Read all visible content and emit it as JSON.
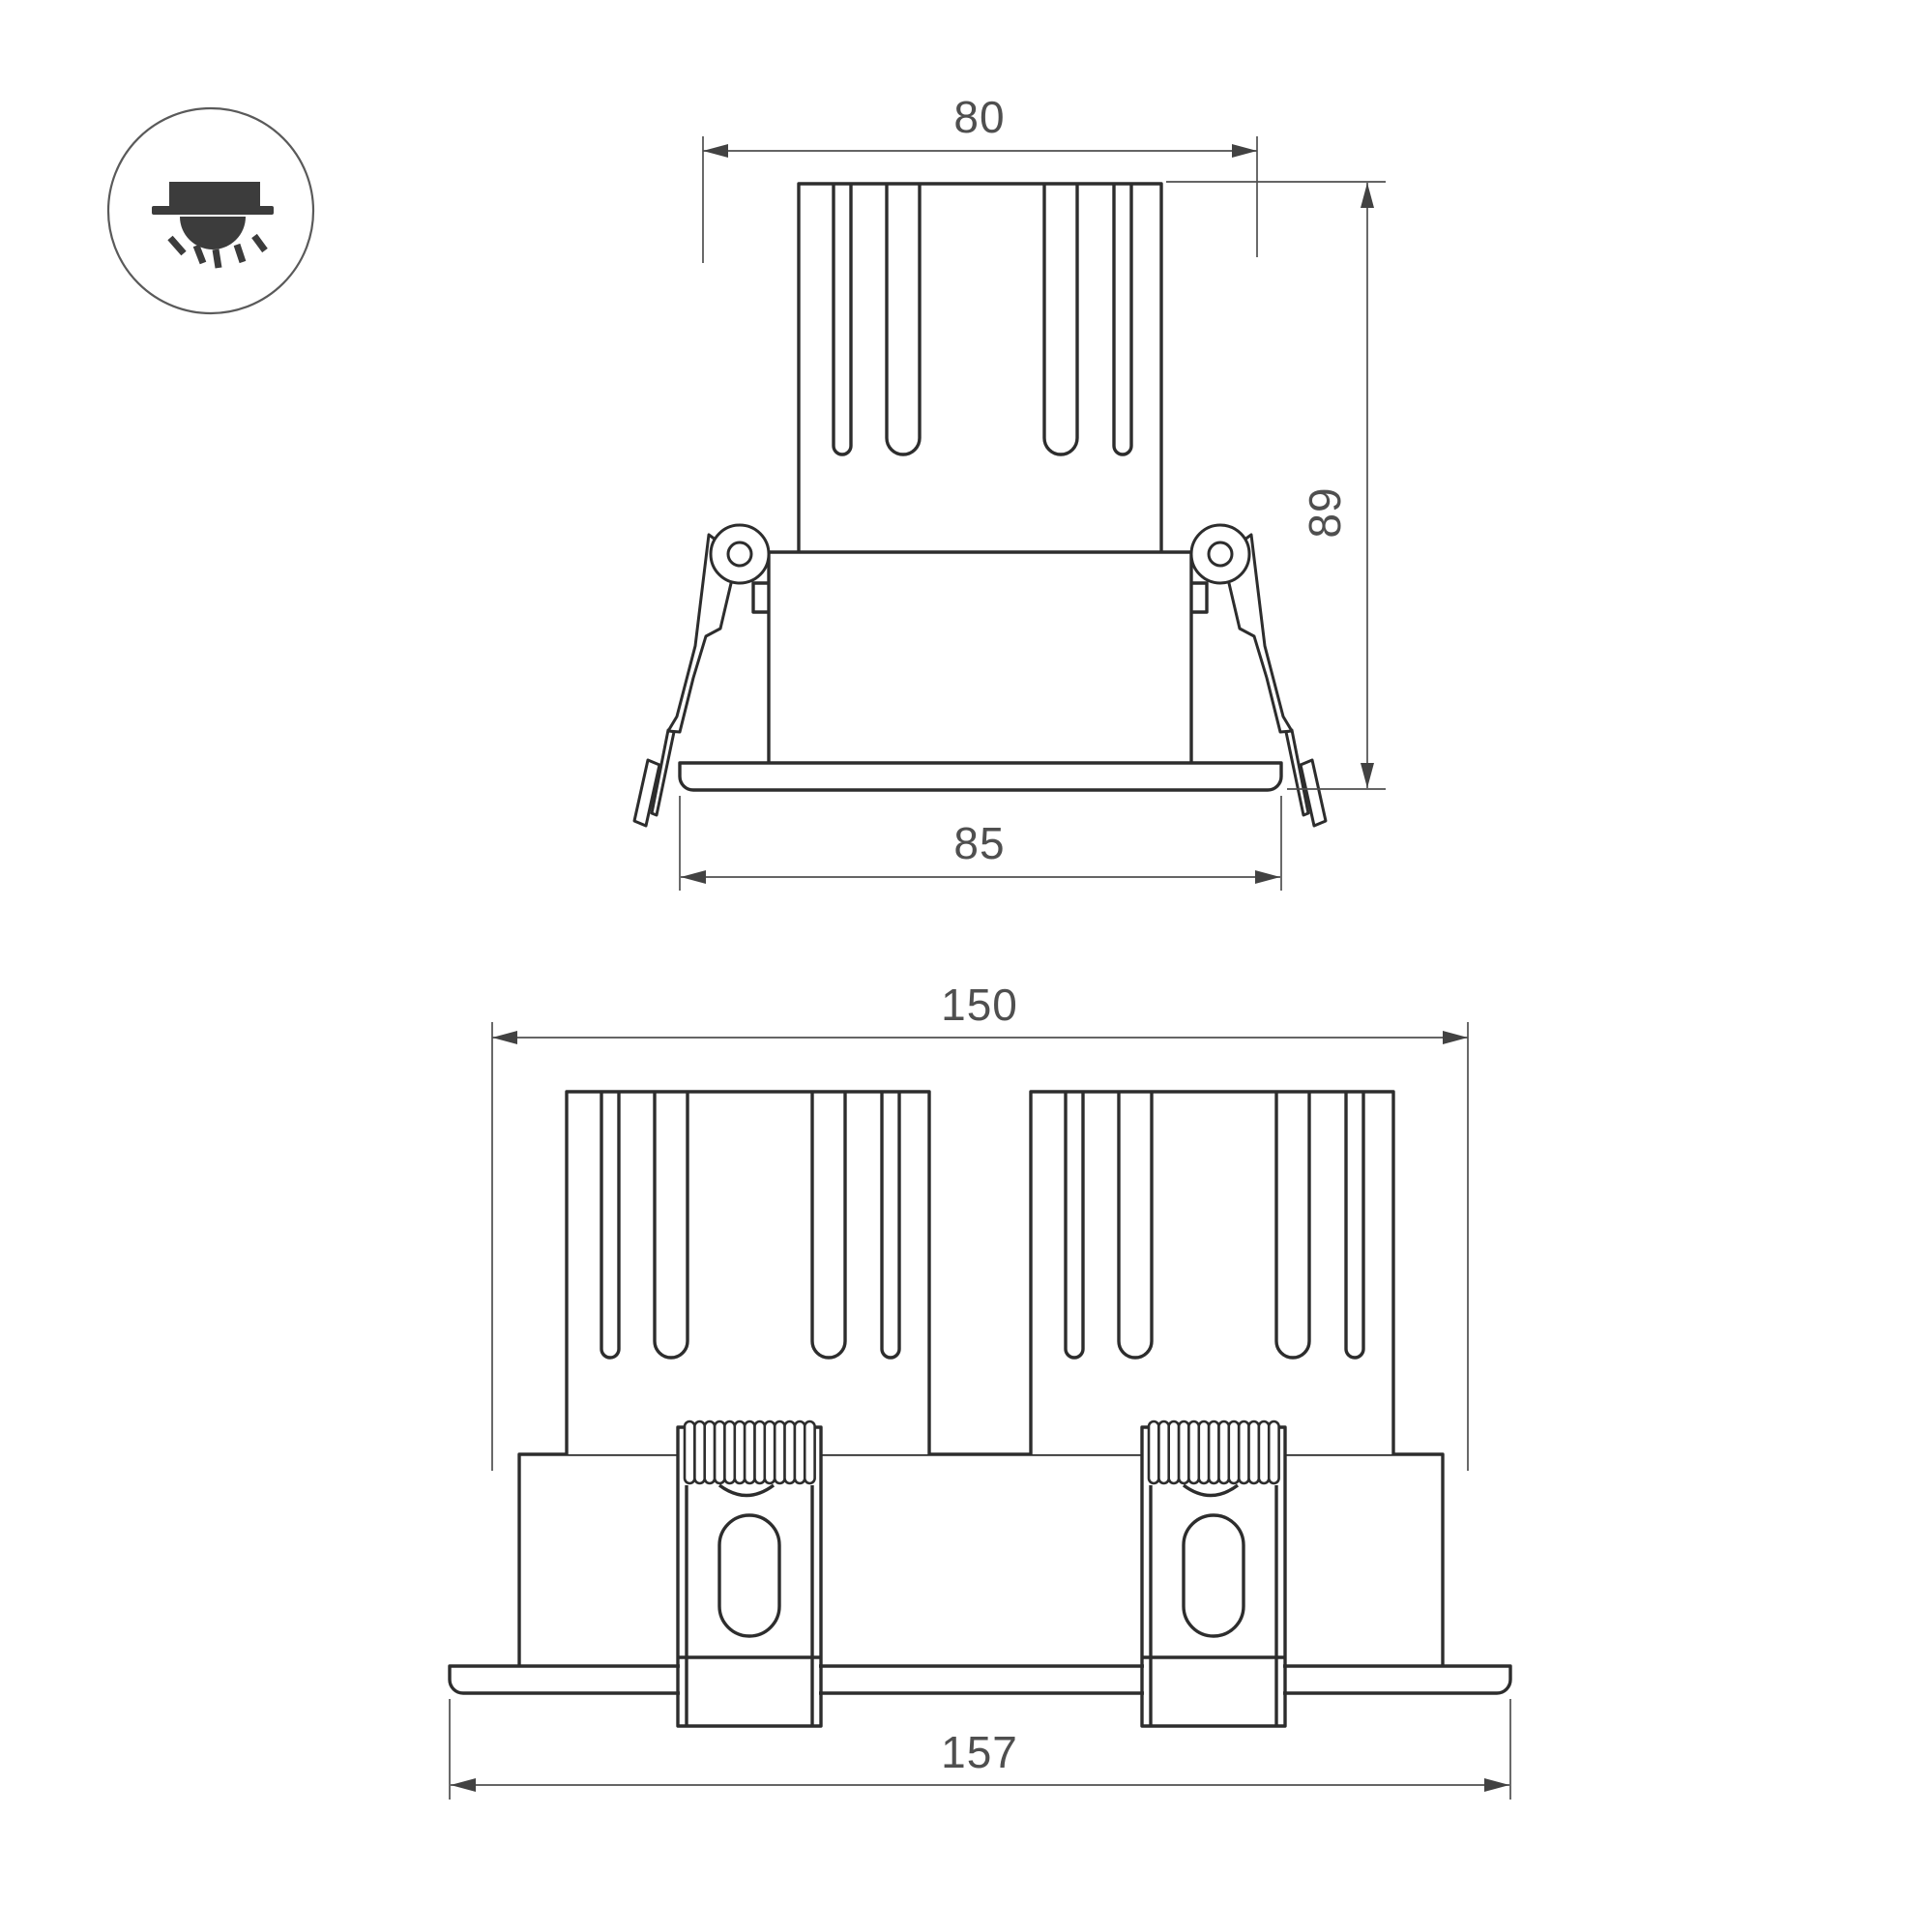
{
  "page": {
    "background": "#ffffff"
  },
  "colors": {
    "outline": "#2d2d2d",
    "dimension_lines": "#4f4f4f",
    "dimension_text": "#4f4f4f",
    "icon_ink": "#3c3c3c"
  },
  "icon": {
    "name": "recessed-downlight-icon"
  },
  "views": {
    "single": {
      "title": "single luminaire front view",
      "dims": {
        "cutout_width": "80",
        "height": "89",
        "flange_width": "85"
      }
    },
    "double": {
      "title": "double luminaire front view",
      "dims": {
        "cutout_width": "150",
        "flange_width": "157"
      }
    }
  }
}
